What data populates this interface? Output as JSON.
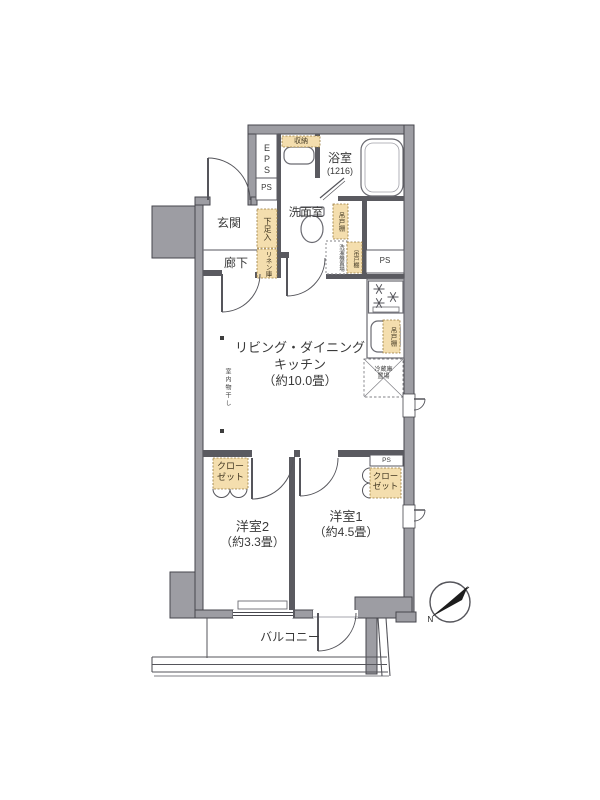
{
  "labels": {
    "entrance": "玄関",
    "hallway": "廊下",
    "washroom": "洗面室",
    "bathroom": "浴室",
    "bathroom_size": "(1216)",
    "ldk_line1": "リビング・ダイニング",
    "ldk_line2": "キッチン",
    "ldk_size": "（約10.0畳）",
    "bedroom1": "洋室1",
    "bedroom1_size": "（約4.5畳）",
    "bedroom2": "洋室2",
    "bedroom2_size": "（約3.3畳）",
    "balcony": "バルコニー",
    "closet": "クローゼット",
    "shoe_cupboard": "下足入",
    "linen_cabinet": "リネン庫",
    "storage_shelf": "収納",
    "hanging_cupboard": "吊戸棚",
    "washer_space": "洗濯機置場",
    "fridge_line1": "冷蔵庫",
    "fridge_line2": "置場",
    "indoor_drying": "室内物干し",
    "eps": "EPS",
    "ps": "PS",
    "north": "N"
  },
  "colors": {
    "wall_gray": "#9d9da3",
    "cabinet_tan": "#f4deae",
    "line_dark": "#46464c"
  }
}
